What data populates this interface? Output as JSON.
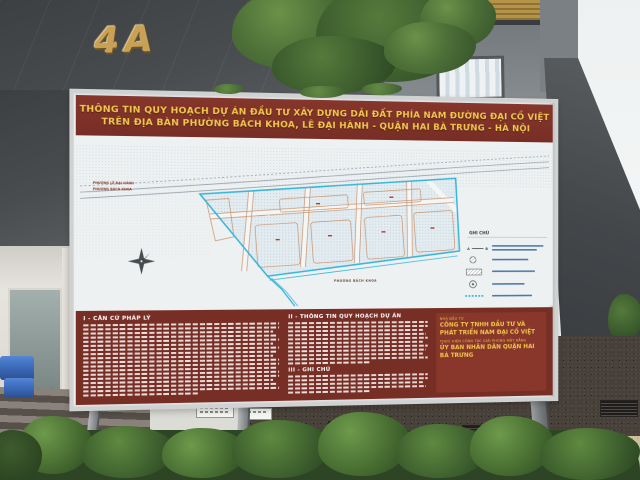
{
  "building": {
    "number": "4A"
  },
  "billboard": {
    "title": {
      "line1": "THÔNG TIN QUY HOẠCH DỰ ÁN ĐẦU TƯ XÂY DỰNG DẢI ĐẤT PHÍA NAM ĐƯỜNG ĐẠI CỒ VIỆT",
      "line2": "TRÊN ĐỊA BÀN PHƯỜNG BÁCH KHOA, LÊ ĐẠI HÀNH - QUẬN HAI BÀ TRƯNG - HÀ NỘI"
    },
    "map": {
      "ward_label_top1": "PHƯỜNG LÊ ĐẠI HÀNH",
      "ward_label_top2": "PHƯỜNG BÁCH KHOA",
      "ward_label_bottom": "PHƯỜNG BÁCH KHOA",
      "legend": {
        "title": "GHI CHÚ",
        "marker_a": "A",
        "marker_b": "B"
      }
    },
    "sections": {
      "legal": {
        "header": "I - CĂN CỨ PHÁP LÝ",
        "line_count": 18
      },
      "planning": {
        "header": "II - THÔNG TIN QUY HOẠCH DỰ ÁN",
        "line_count": 11
      },
      "notes": {
        "header": "III - GHI CHÚ",
        "line_count": 5
      }
    },
    "parties": {
      "investor_label": "NHÀ ĐẦU TƯ",
      "investor_name": "CÔNG TY TNHH ĐẦU TƯ VÀ PHÁT TRIỂN NAM ĐẠI CỒ VIỆT",
      "clearance_label": "THỰC HIỆN CÔNG TÁC GIẢI PHÓNG MẶT BẰNG",
      "clearance_name": "ỦY BAN NHÂN DÂN QUẬN HAI BÀ TRƯNG"
    }
  },
  "colors": {
    "board_red": "#772e25",
    "board_yellow": "#f2c74b",
    "map_boundary_cyan": "#35b5d8",
    "parcel_line_orange": "#c8926a",
    "frame_silver": "#cfd2d1",
    "facade_dark": "#44484a",
    "gold_letters": "#c9a156"
  }
}
